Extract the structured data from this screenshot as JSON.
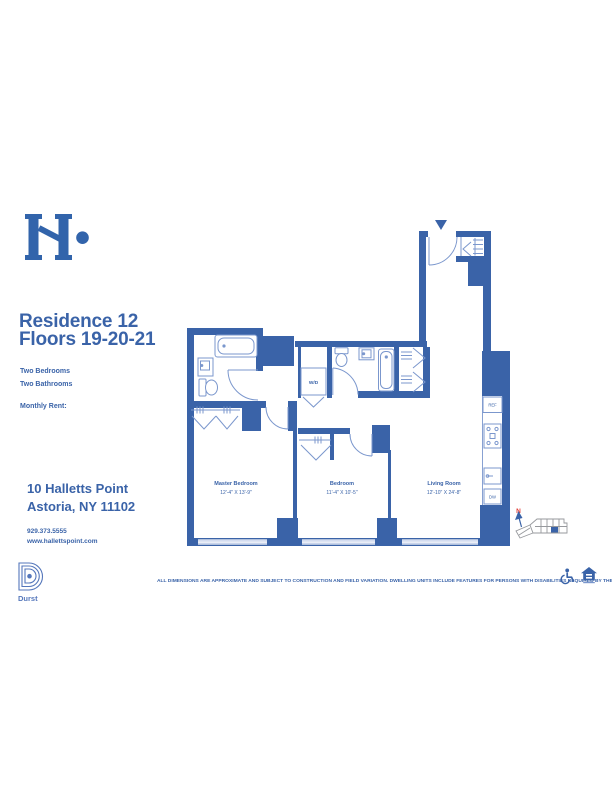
{
  "brand": {
    "logo": "halletts-point-h-mark",
    "developer_logo_label": "Durst"
  },
  "header": {
    "residence_title": "Residence 12",
    "floors_title": "Floors 19-20-21",
    "bedrooms_label": "Two Bedrooms",
    "bathrooms_label": "Two Bathrooms",
    "monthly_rent_label": "Monthly Rent:"
  },
  "contact": {
    "address_line1": "10 Halletts Point",
    "address_line2": "Astoria, NY 11102",
    "phone": "929.373.5555",
    "website": "www.hallettspoint.com"
  },
  "floorplan": {
    "rooms": [
      {
        "name": "Master Bedroom",
        "dimensions": "12'-4\" X 13'-9\""
      },
      {
        "name": "Bedroom",
        "dimensions": "11'-4\" X 10'-5\""
      },
      {
        "name": "Living Room",
        "dimensions": "12'-10\" X 24'-8\""
      }
    ],
    "labels": {
      "washer_dryer": "W/D",
      "refrigerator": "REF",
      "dishwasher": "DW"
    },
    "compass_north": "N",
    "colors": {
      "wall": "#3a63a8",
      "fixture": "#7b97cd",
      "window": "#a9badf",
      "north_arrow": "#e03a34"
    }
  },
  "footer": {
    "disclaimer": "ALL DIMENSIONS ARE APPROXIMATE AND SUBJECT TO CONSTRUCTION AND FIELD VARIATION. DWELLING UNITS INCLUDE FEATURES FOR PERSONS WITH DISABILITIES REQUIRED BY THE FHA.",
    "icons": [
      "wheelchair-accessible-icon",
      "equal-housing-opportunity-icon"
    ]
  }
}
